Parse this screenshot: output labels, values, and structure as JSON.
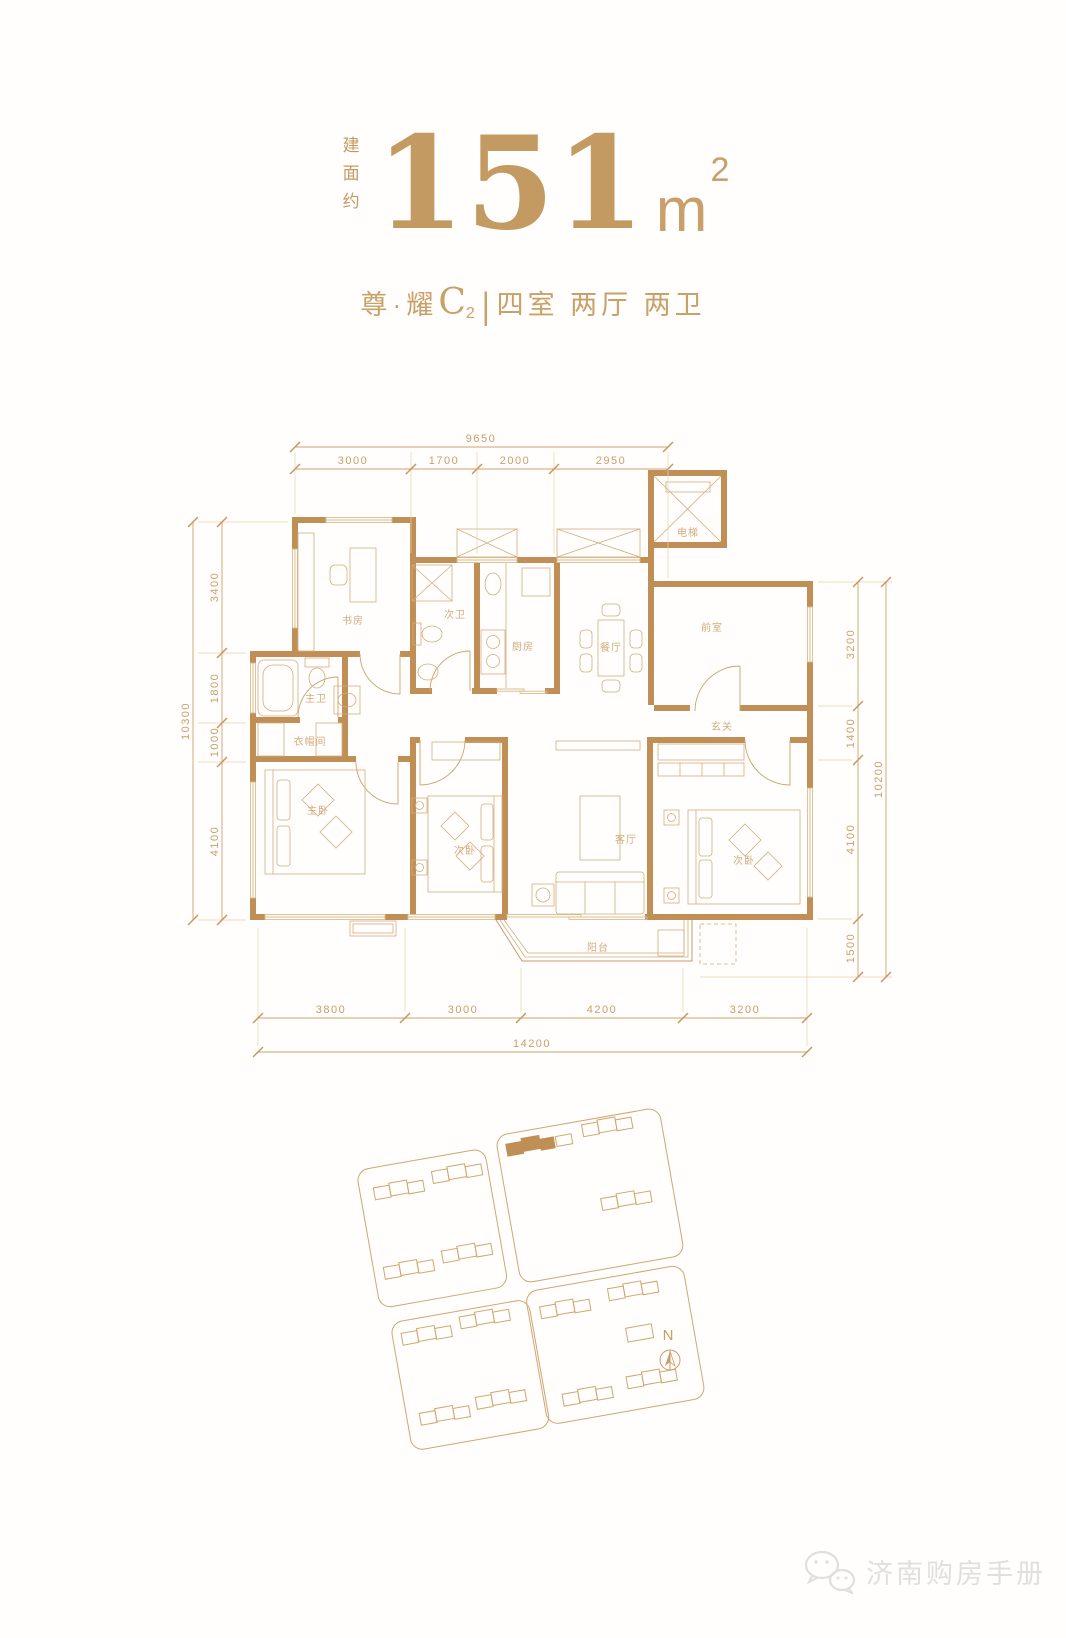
{
  "header": {
    "area_prefix": "建面约",
    "area_value": "151",
    "area_unit": "m",
    "area_exponent": "2",
    "unit_prefix": "尊·耀",
    "unit_letter": "C",
    "unit_index": "2",
    "divider": "|",
    "layout_desc": "四室 两厅 两卫"
  },
  "plan": {
    "rooms": {
      "study": "书房",
      "bath2": "次卫",
      "kitchen": "厨房",
      "dining": "餐厅",
      "elevator": "电梯",
      "front": "前室",
      "master_bath": "主卫",
      "closet": "衣帽间",
      "foyer": "玄关",
      "master_bed": "主卧",
      "bed2": "次卧",
      "living": "客厅",
      "bed3": "次卧",
      "balcony": "阳台"
    },
    "dims": {
      "top_total": "9650",
      "top": [
        "3000",
        "1700",
        "2000",
        "2950"
      ],
      "left_total": "10300",
      "left": [
        "3400",
        "1800",
        "1000",
        "4100"
      ],
      "right_total": "10200",
      "right": [
        "3200",
        "1400",
        "4100",
        "1500"
      ],
      "bottom_total": "14200",
      "bottom": [
        "3800",
        "3000",
        "4200",
        "3200"
      ]
    }
  },
  "site": {
    "north": "N"
  },
  "watermark": {
    "text": "济南购房手册"
  },
  "colors": {
    "gold": "#C49A63",
    "wall": "#C08F55",
    "line": "#C9996A",
    "dim_text": "#C99E6B",
    "watermark": "#DFDFDF"
  }
}
